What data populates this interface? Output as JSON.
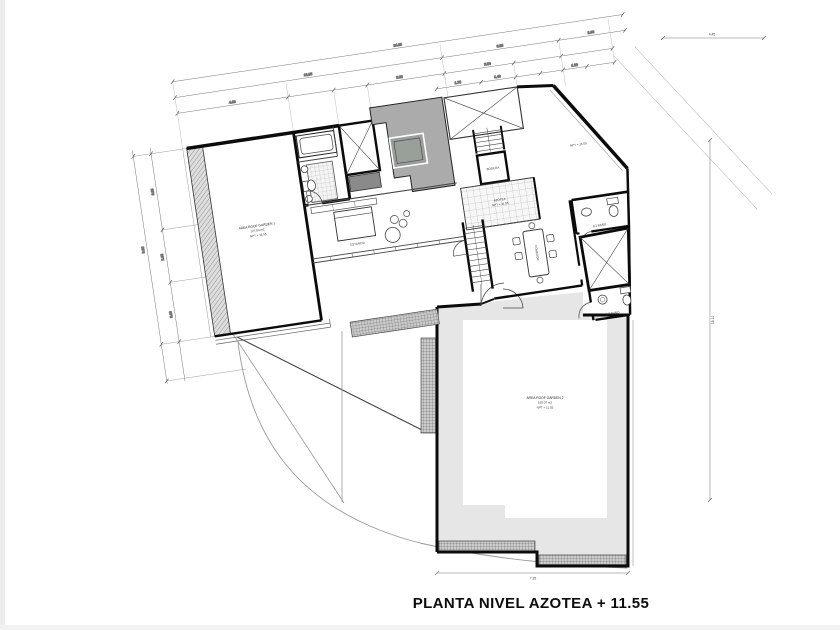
{
  "title": "PLANTA NIVEL AZOTEA + 11.55",
  "rooms": {
    "roof_garden_1": {
      "name": "AREA ROOF GARDEN 1",
      "area": "127.04 m2",
      "level": "NPT + 11.55"
    },
    "roof_garden_2": {
      "name": "AREA ROOF GARDEN 2",
      "area": "165.07 m2",
      "level": "NPT + 11.55"
    },
    "azotea": {
      "name": "AZOTEA",
      "level": "NPT + 11.55"
    },
    "bodega": {
      "name": "BODEGA"
    },
    "estancia": {
      "name": "ESTANCIA"
    },
    "comedor": {
      "name": "COMEDOR"
    },
    "half_bath_top": {
      "name": "1/2 BAÑO"
    },
    "half_bath_bottom": {
      "name": "1/2 BAÑO"
    },
    "top_right": {
      "level": "NPT + 11.55"
    }
  },
  "dimensions": {
    "top": {
      "d1": "24.25",
      "d2": "12.85",
      "d3": "5.95",
      "d4": "2.60",
      "d5": "4.60",
      "d6": "3.25",
      "d7": "2.90",
      "d8": "1.75",
      "d9": "1.40",
      "d10": "1.20"
    },
    "left": {
      "l1": "9.30",
      "l2": "3.85",
      "l3": "2.65",
      "l4": "3.00"
    },
    "right": {
      "r1": "18.10"
    },
    "bottom": {
      "b1": "7.25"
    },
    "top_right": {
      "t1": "4.45"
    }
  },
  "colors": {
    "wall": "#0b0b0b",
    "planter_gray": "#ababab",
    "skylight_gray": "#99a09a",
    "terrace_gray": "#e6e6e6",
    "line": "#444444"
  }
}
